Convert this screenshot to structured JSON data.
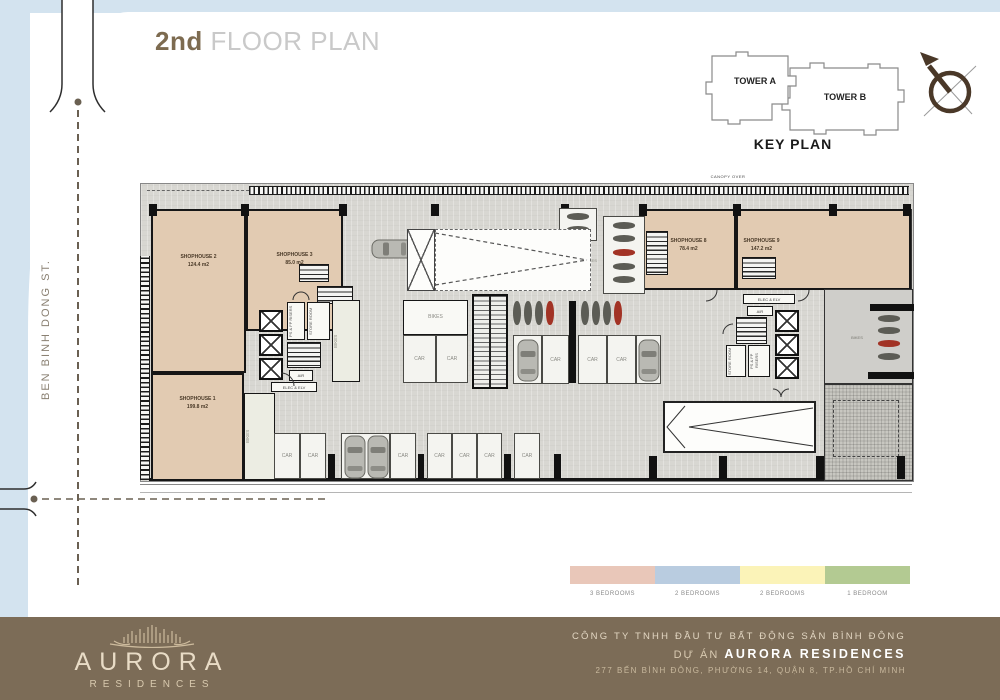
{
  "page": {
    "title_prefix": "2nd",
    "title_rest": "FLOOR PLAN",
    "street_name": "BEN BINH DONG ST."
  },
  "key_plan": {
    "title": "KEY PLAN",
    "tower_a": "TOWER A",
    "tower_b": "TOWER B"
  },
  "plan": {
    "canopy_label": "CANOPY OVER",
    "shophouses": {
      "sh1": {
        "name": "SHOPHOUSE 1",
        "area": "199.8 m2"
      },
      "sh2": {
        "name": "SHOPHOUSE 2",
        "area": "124.4 m2"
      },
      "sh3": {
        "name": "SHOPHOUSE 3",
        "area": "85.0 m2"
      },
      "sh8": {
        "name": "SHOPHOUSE 8",
        "area": "78.4 m2"
      },
      "sh9": {
        "name": "SHOPHOUSE 9",
        "area": "147.2 m2"
      }
    },
    "labels": {
      "car": "CAR",
      "bikes": "BIKES",
      "elec_elv": "ELEC & ELV",
      "air": "AIR",
      "ps_fp_risers": "PS & FP RISERS",
      "store_room": "STORE ROOM"
    }
  },
  "legend": {
    "items": [
      {
        "label": "3 BEDROOMS",
        "color": "#e9c7b9"
      },
      {
        "label": "2 BEDROOMS",
        "color": "#b9cce0"
      },
      {
        "label": "2 BEDROOMS",
        "color": "#fbf3b8"
      },
      {
        "label": "1 BEDROOM",
        "color": "#b3ca92"
      }
    ]
  },
  "footer": {
    "brand": "AURORA",
    "brand_sub": "RESIDENCES",
    "company": "CÔNG TY TNHH ĐẦU TƯ BẤT ĐỘNG SẢN BÌNH ĐÔNG",
    "project_prefix": "DỰ ÁN",
    "project_name": "AURORA RESIDENCES",
    "address": "277 BẾN BÌNH ĐÔNG, PHƯỜNG 14, QUẬN 8, TP.HỒ CHÍ MINH"
  },
  "icons": {
    "compass": "north-arrow-compass",
    "car": "car-top-view",
    "bike": "motorbike-top-view",
    "crown": "aurora-crown-logo"
  },
  "colors": {
    "page_margin_blue": "#d3e3ef",
    "plan_floor": "#d8d7d2",
    "shophouse_fill": "#e2cbb2",
    "footer_brown": "#7c6c57",
    "title_brown": "#7d6b50"
  }
}
